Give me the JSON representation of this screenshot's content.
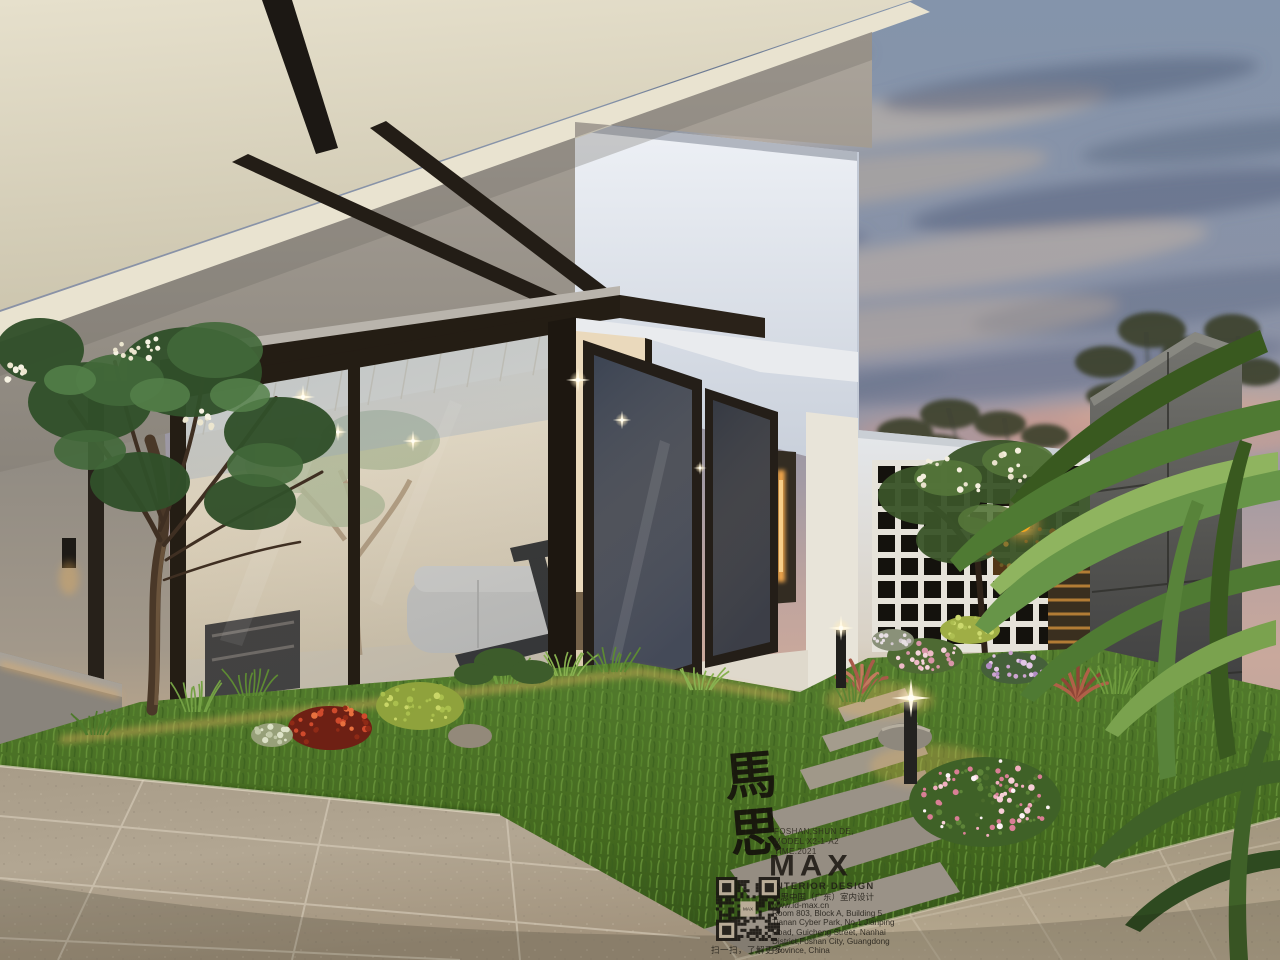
{
  "watermark": {
    "calligraphy": "馬思",
    "calligraphy_chars": [
      "馬",
      "思"
    ],
    "info_lines": [
      "FOSHAN,SHUN DE,",
      "MODEL X2-1-A2",
      "TIME:2021"
    ],
    "logo": "MAX",
    "subtitle": "INTERIOR DESIGN",
    "company_cn": "马思中国（广东）室内设计",
    "website": "www.id-max.cn",
    "address_lines": [
      "Room 803, Block A, Building 5",
      "Tianan Cyber Park, No.1 Jianping",
      "Road, Guicheng Street, Nanhai",
      "District,Foshan City, Guangdong",
      "Province, China"
    ],
    "qr_center_label": "MAX",
    "qr_caption": "扫一扫，了解更多"
  },
  "palette": {
    "sky_top": "#8494ab",
    "sky_horizon_warm": "#c9a89c",
    "eave_cream": "#ddd6c0",
    "wall_grey": "#a19b92",
    "house_white": "#e8ecf2",
    "frame_bronze": "#261f16",
    "interior_warm": "#e7d9bf",
    "led_glow": "#f5bb62",
    "grass_green": "#4f7a2e",
    "paver_tan": "#ab9f8c",
    "stone_pillar": "#4a4a46",
    "lantern_orange": "#f6a81f"
  }
}
